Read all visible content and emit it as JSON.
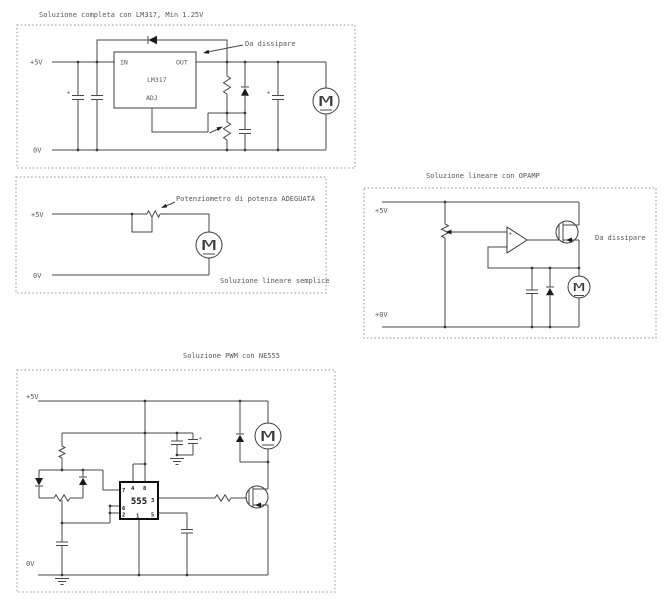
{
  "motor_letter": "M",
  "polarity_plus": "+",
  "circuits": {
    "lm317": {
      "title": "Soluzione completa con LM317, Min 1.25V",
      "rail_top_label": "+5V",
      "rail_bottom_label": "0V",
      "ic_name": "LM317",
      "pin_in": "IN",
      "pin_out": "OUT",
      "pin_adj": "ADJ",
      "annotation_dissipate": "Da dissipare"
    },
    "linear_simple": {
      "caption": "Soluzione lineare semplice",
      "rail_top_label": "+5V",
      "rail_bottom_label": "0V",
      "annotation_potentiometer": "Potenziometro di potenza ADEGUATA"
    },
    "opamp": {
      "title": "Soluzione lineare con OPAMP",
      "rail_top_label": "+5V",
      "rail_bottom_label": "+0V",
      "annotation_dissipate": "Da dissipare",
      "opamp_plus_input": "+"
    },
    "pwm": {
      "title": "Soluzione PWM con NE555",
      "rail_top_label": "+5V",
      "rail_bottom_label": "0V",
      "ic_name": "555",
      "pins": {
        "1": "1",
        "2": "2",
        "3": "3",
        "4": "4",
        "5": "5",
        "6": "6",
        "7": "7",
        "8": "8"
      }
    }
  }
}
